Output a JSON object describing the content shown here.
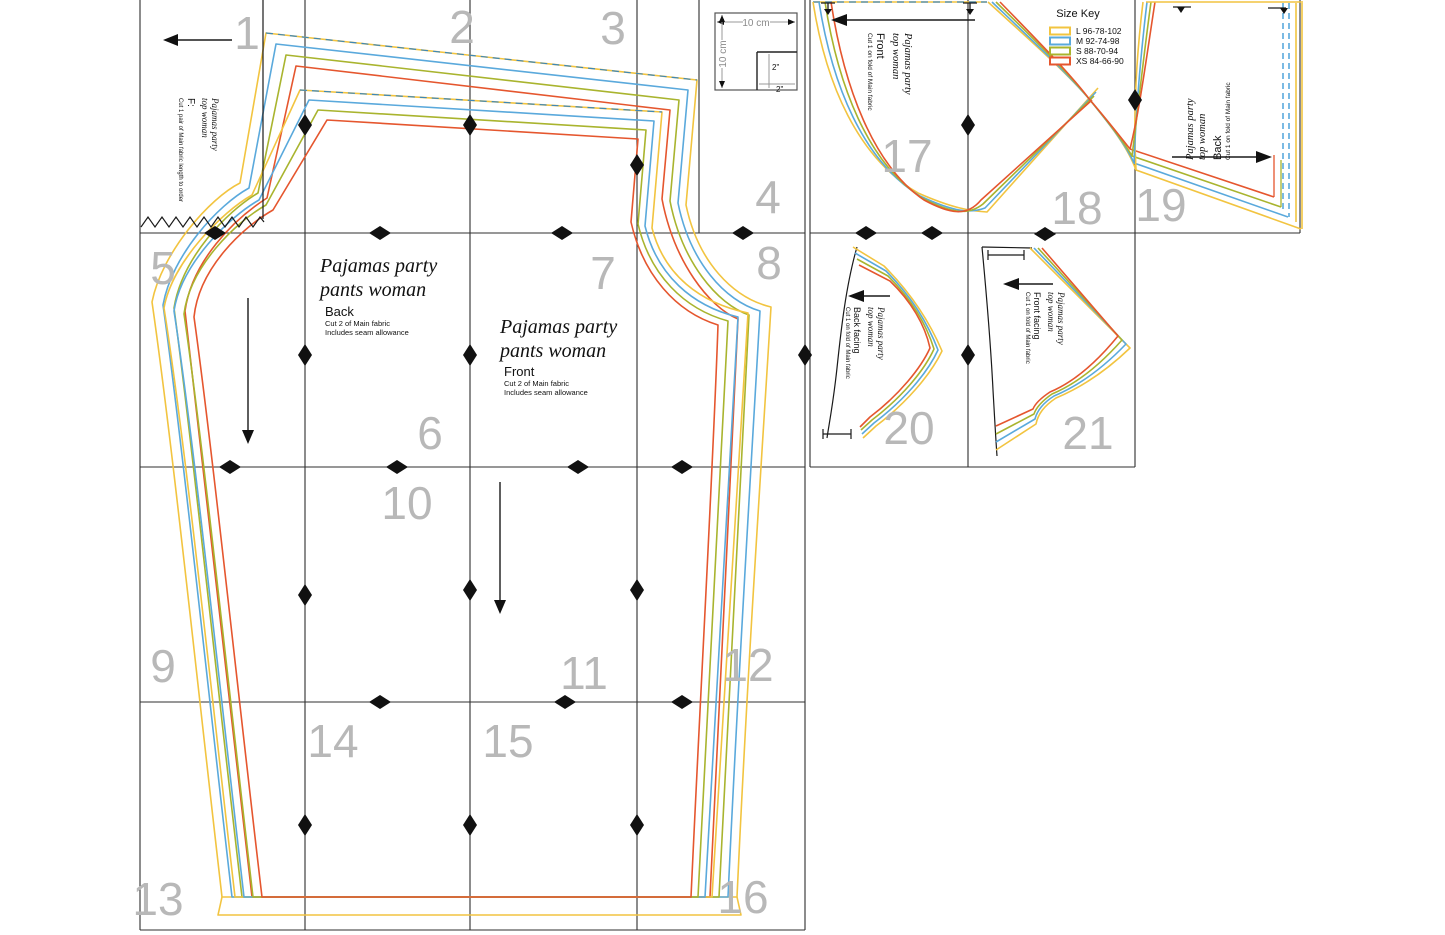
{
  "size_key": {
    "title": "Size Key",
    "entries": [
      {
        "label": "L 96-78-102",
        "color": "#F2C440"
      },
      {
        "label": "M 92-74-98",
        "color": "#5AA9DC"
      },
      {
        "label": "S 88-70-94",
        "color": "#A9B42E"
      },
      {
        "label": "XS 84-66-90",
        "color": "#E5562E"
      }
    ]
  },
  "test_square": {
    "h_label": "10 cm",
    "v_label": "10 cm",
    "inner_h_label": "2\"",
    "inner_v_label": "2\""
  },
  "pages": [
    {
      "n": "1",
      "x": 247,
      "y": 33
    },
    {
      "n": "2",
      "x": 462,
      "y": 27
    },
    {
      "n": "3",
      "x": 613,
      "y": 28
    },
    {
      "n": "4",
      "x": 768,
      "y": 197
    },
    {
      "n": "5",
      "x": 163,
      "y": 268
    },
    {
      "n": "6",
      "x": 430,
      "y": 433
    },
    {
      "n": "7",
      "x": 603,
      "y": 273
    },
    {
      "n": "8",
      "x": 769,
      "y": 263
    },
    {
      "n": "9",
      "x": 163,
      "y": 666
    },
    {
      "n": "10",
      "x": 407,
      "y": 503
    },
    {
      "n": "11",
      "x": 584,
      "y": 673
    },
    {
      "n": "12",
      "x": 748,
      "y": 665
    },
    {
      "n": "13",
      "x": 158,
      "y": 899
    },
    {
      "n": "14",
      "x": 333,
      "y": 741
    },
    {
      "n": "15",
      "x": 508,
      "y": 741
    },
    {
      "n": "16",
      "x": 743,
      "y": 897
    },
    {
      "n": "17",
      "x": 907,
      "y": 156
    },
    {
      "n": "18",
      "x": 1077,
      "y": 208
    },
    {
      "n": "19",
      "x": 1161,
      "y": 205
    },
    {
      "n": "20",
      "x": 909,
      "y": 428
    },
    {
      "n": "21",
      "x": 1088,
      "y": 433
    }
  ],
  "pieces": {
    "pants_back": {
      "title1": "Pajamas party",
      "title2": "pants woman",
      "name": "Back",
      "cut": "Cut 2 of Main fabric",
      "note": "Includes seam allowance"
    },
    "pants_front": {
      "title1": "Pajamas party",
      "title2": "pants woman",
      "name": "Front",
      "cut": "Cut 2 of Main fabric",
      "note": "Includes seam allowance"
    },
    "top_front": {
      "title1": "Pajamas party",
      "title2": "top woman",
      "name": "Front",
      "cut": "Cut 1 on fold of Main fabric"
    },
    "top_back": {
      "title1": "Pajamas party",
      "title2": "top woman",
      "name": "Back",
      "cut": "Cut 1 on fold of Main fabric"
    },
    "back_facing": {
      "title1": "Pajamas party",
      "title2": "top woman",
      "name": "Back facing",
      "cut": "Cut 1 on fold of Main fabric"
    },
    "front_facing": {
      "title1": "Pajamas party",
      "title2": "top woman",
      "name": "Front facing",
      "cut": "Cut 1 on fold of Main fabric"
    },
    "tie": {
      "title1": "Pajamas party",
      "title2": "top woman",
      "name": "F:",
      "cut": "Cut 1 pair of Main fabric length to order"
    }
  }
}
